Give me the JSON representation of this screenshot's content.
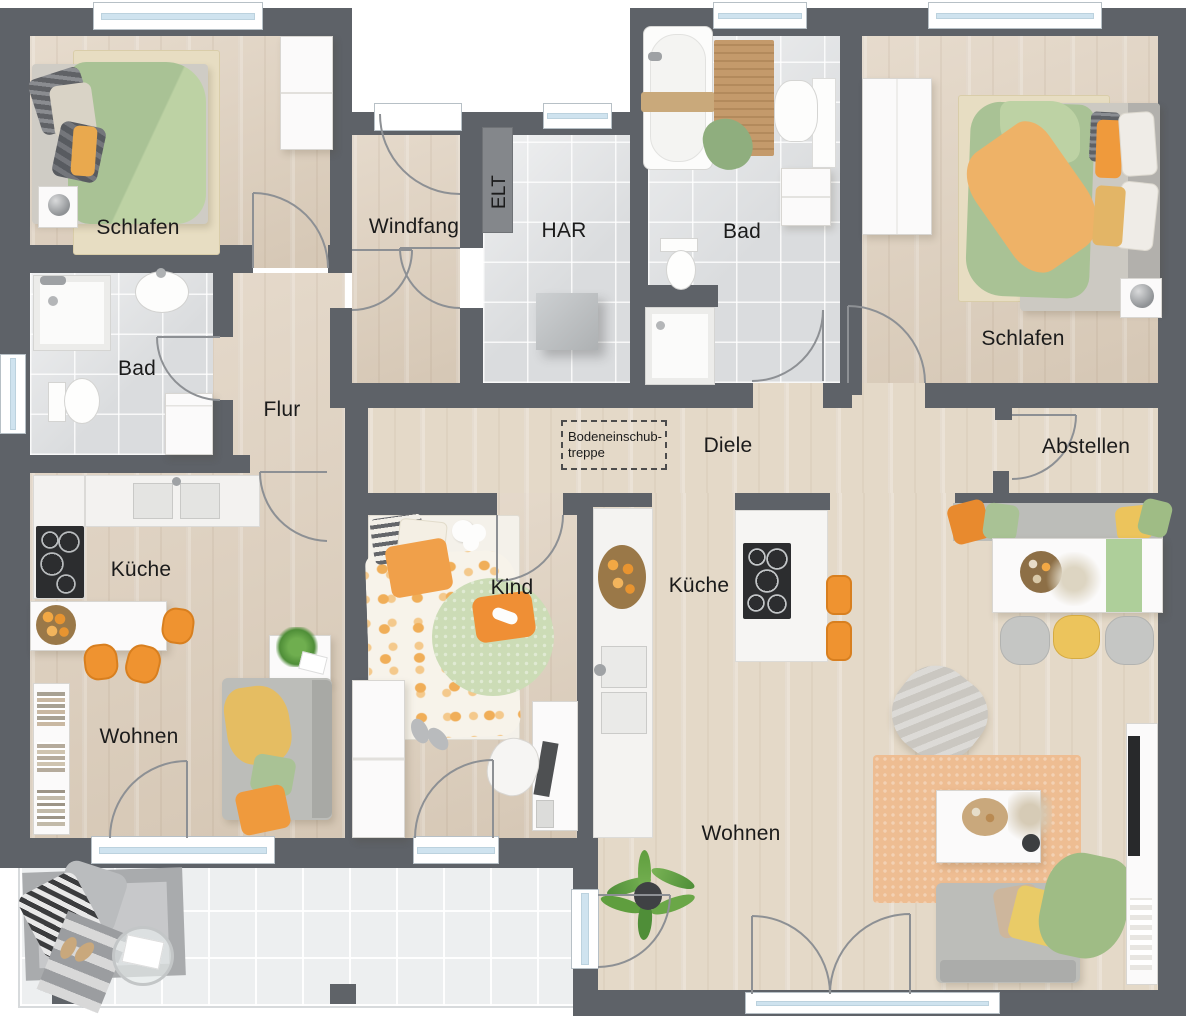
{
  "rooms": {
    "schlafen_left": "Schlafen",
    "windfang": "Windfang",
    "elt": "ELT",
    "har": "HAR",
    "bad_top": "Bad",
    "schlafen_right": "Schlafen",
    "bad_left": "Bad",
    "flur": "Flur",
    "diele": "Diele",
    "abstellen": "Abstellen",
    "kueche_left": "Küche",
    "kind": "Kind",
    "kueche_right": "Küche",
    "wohnen_left": "Wohnen",
    "wohnen_right": "Wohnen"
  },
  "annotations": {
    "attic_stairs_line1": "Bodeneinschub-",
    "attic_stairs_line2": "treppe"
  },
  "colors": {
    "wall": "#5e6268",
    "wood_floor": "#decfbc",
    "wood_floor_light": "#e4d9c8",
    "tile_floor": "#e1e3e5",
    "terrace_tile": "#edeff0",
    "window_glass": "#cfe3ef",
    "accent_orange": "#ef9330",
    "accent_green": "#a9c295",
    "accent_yellow": "#e8c369",
    "label_text": "#1b1b1b"
  }
}
